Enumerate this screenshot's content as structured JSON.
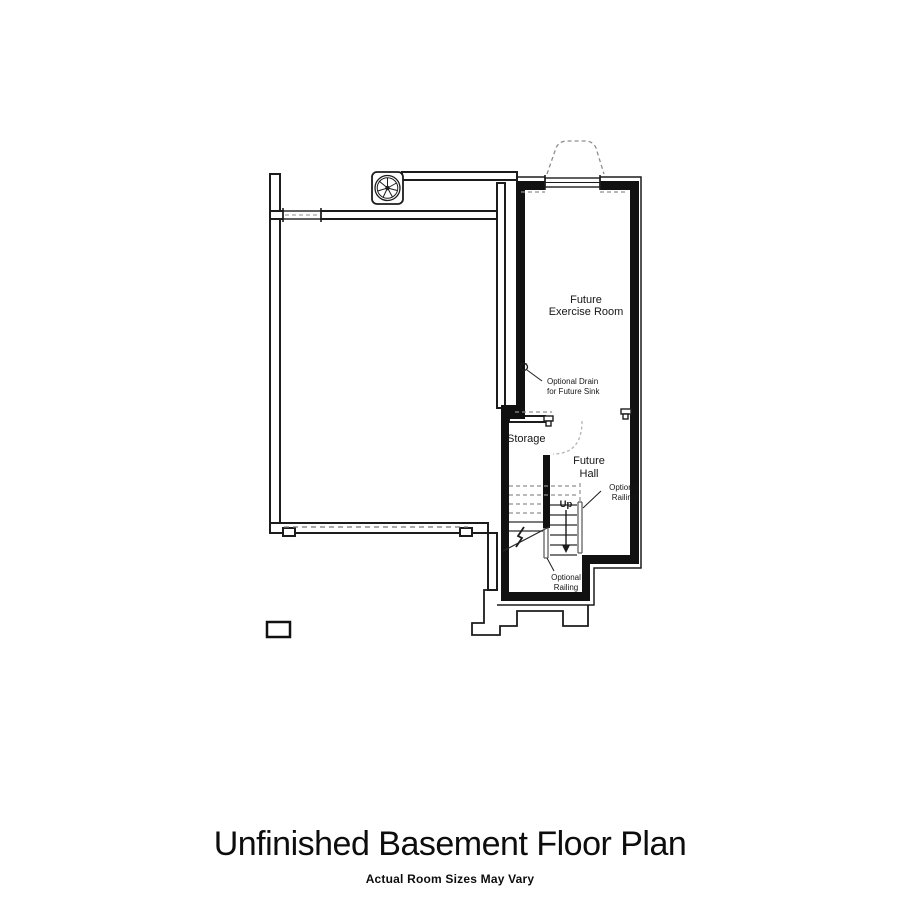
{
  "titleblock": {
    "title": "Unfinished Basement Floor Plan",
    "subtitle": "Actual Room Sizes May Vary"
  },
  "plan": {
    "rooms": {
      "exercise": {
        "lines": [
          "Future",
          "Exercise Room"
        ]
      },
      "storage": {
        "label": "Storage"
      },
      "hall": {
        "lines": [
          "Future",
          "Hall"
        ]
      }
    },
    "annotations": {
      "up": "Up",
      "drain": {
        "lines": [
          "Optional Drain",
          "for Future Sink"
        ]
      },
      "railing_right": {
        "lines": [
          "Optional",
          "Railing"
        ]
      },
      "railing_bottom": {
        "lines": [
          "Optional",
          "Railing"
        ]
      }
    },
    "fixtures": {
      "fan": "ceiling-exhaust-fan",
      "window_well": "window-well",
      "pier": "foundation-pier"
    },
    "colors": {
      "wall": "#111111",
      "thin_line": "#1c1c1c",
      "hidden_dashed": "#8f8f8f",
      "door_arc": "#b5b5b5",
      "text": "#161616",
      "background": "#ffffff"
    }
  }
}
